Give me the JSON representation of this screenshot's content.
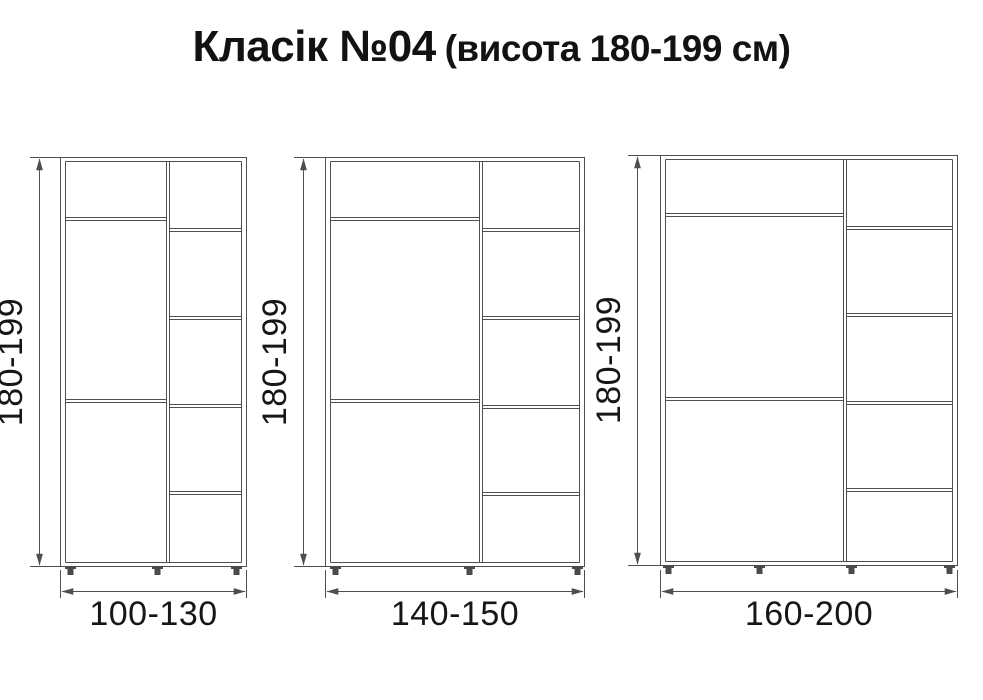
{
  "title": {
    "main": "Класік №04",
    "suffix": "(висота 180-199 см)"
  },
  "colors": {
    "background": "#ffffff",
    "drawing_line": "#4f4f4f",
    "text": "#161616"
  },
  "wardrobes": [
    {
      "id": 1,
      "height_label": "180-199",
      "width_label": "100-130",
      "left_column_sections": 3,
      "right_column_sections": 5,
      "feet_count": 3
    },
    {
      "id": 2,
      "height_label": "180-199",
      "width_label": "140-150",
      "left_column_sections": 3,
      "right_column_sections": 5,
      "feet_count": 3
    },
    {
      "id": 3,
      "height_label": "180-199",
      "width_label": "160-200",
      "left_column_sections": 3,
      "right_column_sections": 5,
      "feet_count": 4
    }
  ]
}
